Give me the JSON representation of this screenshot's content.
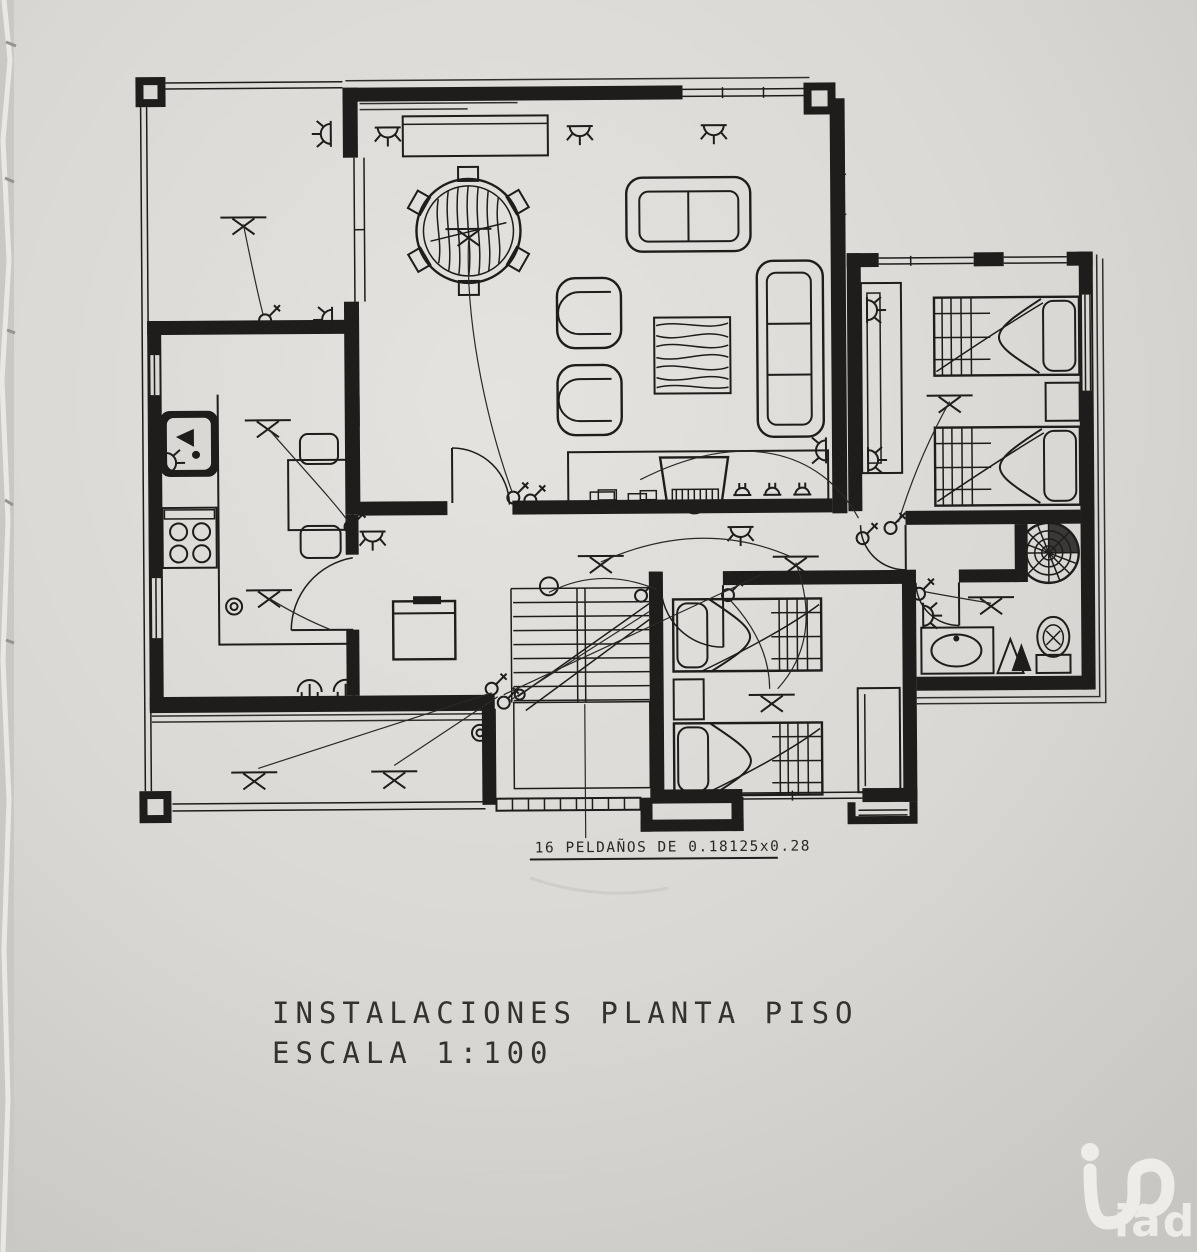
{
  "title_block": {
    "line1": "INSTALACIONES PLANTA PISO",
    "line2": "ESCALA 1:100"
  },
  "annotations": {
    "stair_note": "16 PELDAÑOS DE 0.18125x0.28"
  },
  "watermark": {
    "text": "iad"
  },
  "colors": {
    "paper": "#dad8d4",
    "ink": "#1e1d1b",
    "watermark": "#f1efeb"
  },
  "symbols": [
    "ceiling-light-icon",
    "wall-sconce-icon",
    "power-socket-icon",
    "switch-icon",
    "wiring-run",
    "door-swing",
    "window-band",
    "spiral-fan-icon"
  ]
}
